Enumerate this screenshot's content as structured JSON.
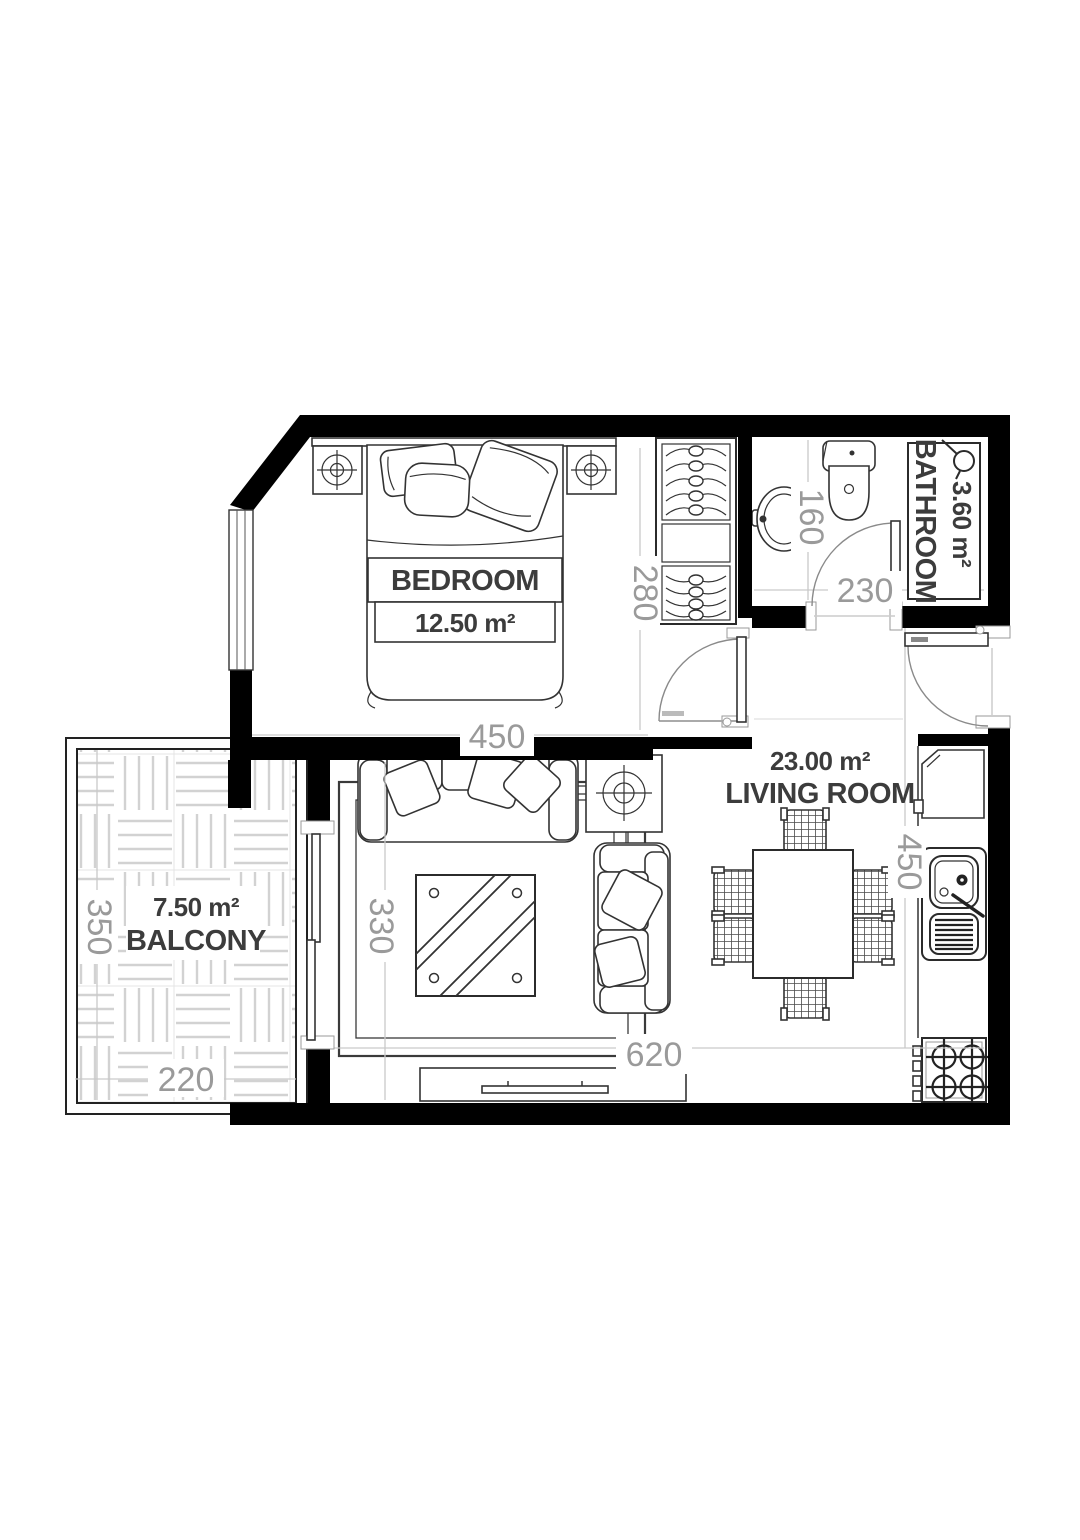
{
  "plan": {
    "title": "apartment-floor-plan",
    "rooms": [
      {
        "id": "bedroom",
        "name": "BEDROOM",
        "area": "12.50 m²"
      },
      {
        "id": "bathroom",
        "name": "BATHROOM",
        "area": "3.60 m²"
      },
      {
        "id": "living",
        "name": "LIVING ROOM",
        "area": "23.00 m²"
      },
      {
        "id": "balcony",
        "name": "BALCONY",
        "area": "7.50 m²"
      }
    ],
    "dimensions": {
      "bedroom_width": "450",
      "bedroom_depth": "280",
      "bathroom_depth": "160",
      "bathroom_width": "230",
      "living_width": "620",
      "living_depth": "450",
      "living_inner_width": "330",
      "balcony_depth": "350",
      "balcony_width": "220"
    },
    "colors": {
      "wall": "#000000",
      "dimension_text": "#9a9a9a",
      "label_text": "#3c3c3c",
      "deck_line": "#d2d2d2",
      "guide_line": "#c9c9c9"
    }
  }
}
